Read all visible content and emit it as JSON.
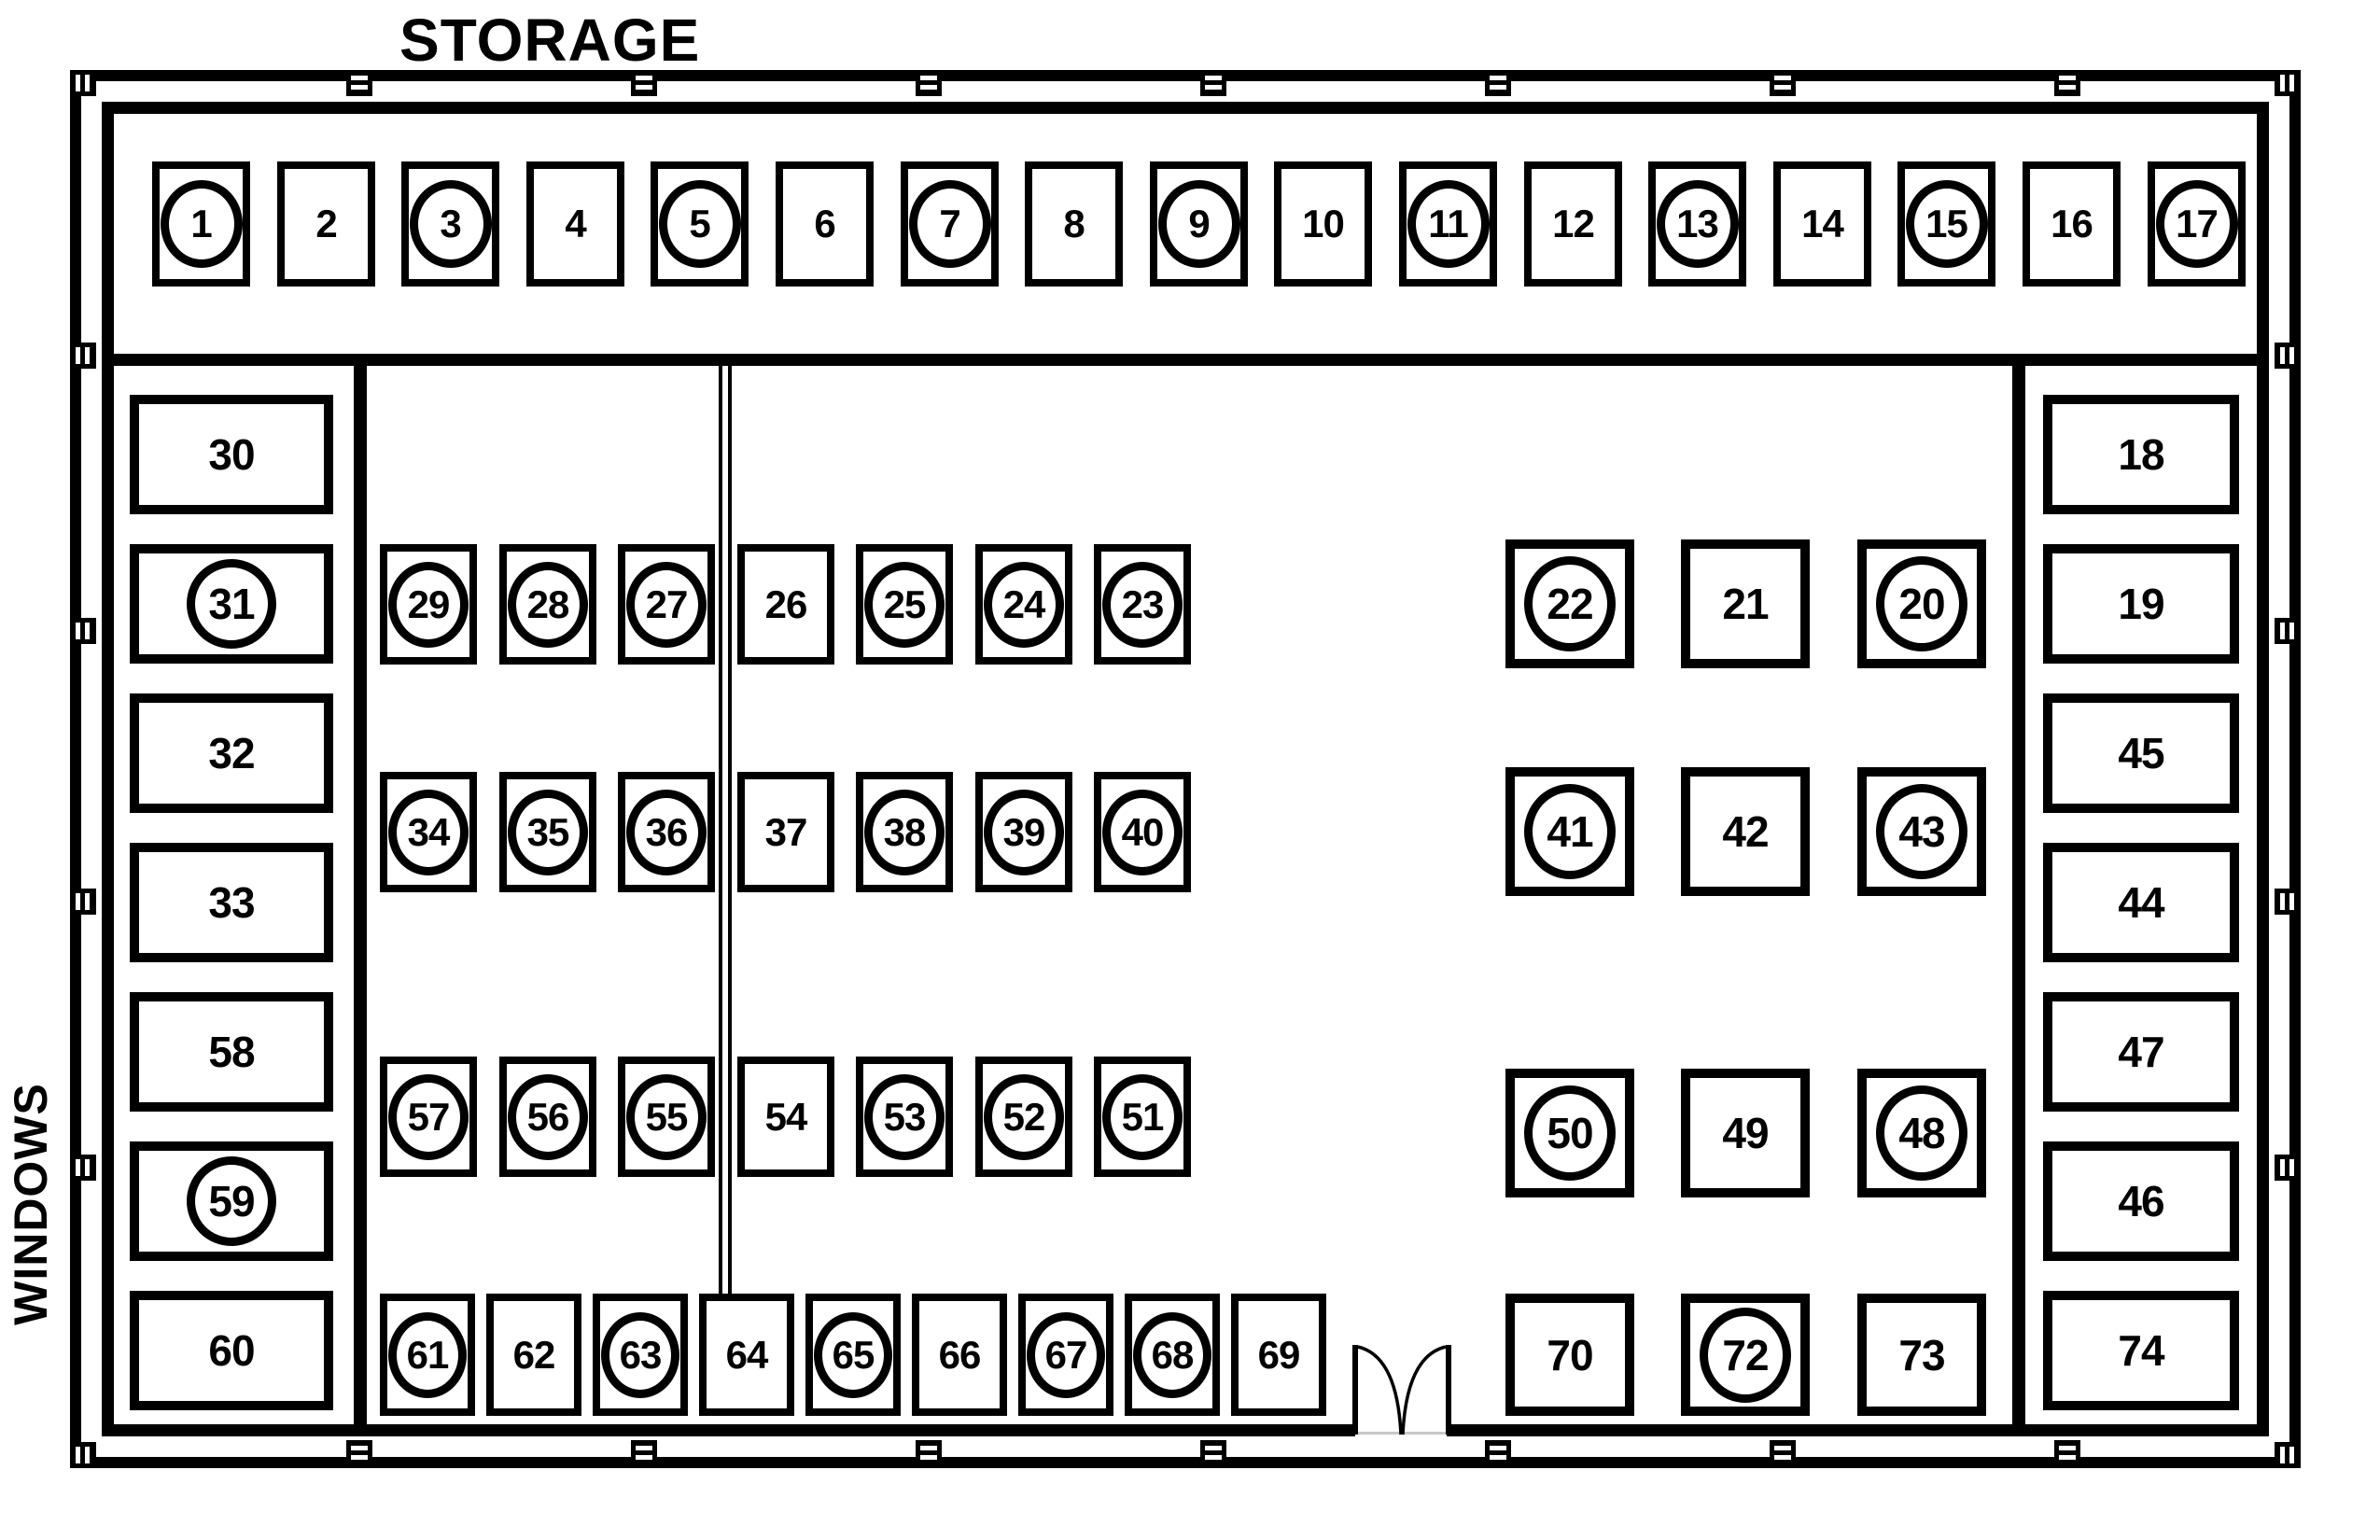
{
  "labels": {
    "storage": "STORAGE",
    "windows": "WINDOWS"
  },
  "colors": {
    "line": "#000000",
    "background": "#ffffff",
    "threshold": "#c8c8c8"
  },
  "groups": {
    "top_row": [
      {
        "n": "1",
        "circled": true
      },
      {
        "n": "2",
        "circled": false
      },
      {
        "n": "3",
        "circled": true
      },
      {
        "n": "4",
        "circled": false
      },
      {
        "n": "5",
        "circled": true
      },
      {
        "n": "6",
        "circled": false
      },
      {
        "n": "7",
        "circled": true
      },
      {
        "n": "8",
        "circled": false
      },
      {
        "n": "9",
        "circled": true
      },
      {
        "n": "10",
        "circled": false
      },
      {
        "n": "11",
        "circled": true
      },
      {
        "n": "12",
        "circled": false
      },
      {
        "n": "13",
        "circled": true
      },
      {
        "n": "14",
        "circled": false
      },
      {
        "n": "15",
        "circled": true
      },
      {
        "n": "16",
        "circled": false
      },
      {
        "n": "17",
        "circled": true
      }
    ],
    "left_column": [
      {
        "n": "30",
        "circled": false
      },
      {
        "n": "31",
        "circled": true
      },
      {
        "n": "32",
        "circled": false
      },
      {
        "n": "33",
        "circled": false
      },
      {
        "n": "58",
        "circled": false
      },
      {
        "n": "59",
        "circled": true
      },
      {
        "n": "60",
        "circled": false
      }
    ],
    "right_column": [
      {
        "n": "18",
        "circled": false
      },
      {
        "n": "19",
        "circled": false
      },
      {
        "n": "45",
        "circled": false
      },
      {
        "n": "44",
        "circled": false
      },
      {
        "n": "47",
        "circled": false
      },
      {
        "n": "46",
        "circled": false
      },
      {
        "n": "74",
        "circled": false
      }
    ],
    "mid_rows": [
      [
        {
          "n": "29",
          "circled": true
        },
        {
          "n": "28",
          "circled": true
        },
        {
          "n": "27",
          "circled": true
        },
        {
          "n": "26",
          "circled": false
        },
        {
          "n": "25",
          "circled": true
        },
        {
          "n": "24",
          "circled": true
        },
        {
          "n": "23",
          "circled": true
        }
      ],
      [
        {
          "n": "34",
          "circled": true
        },
        {
          "n": "35",
          "circled": true
        },
        {
          "n": "36",
          "circled": true
        },
        {
          "n": "37",
          "circled": false
        },
        {
          "n": "38",
          "circled": true
        },
        {
          "n": "39",
          "circled": true
        },
        {
          "n": "40",
          "circled": true
        }
      ],
      [
        {
          "n": "57",
          "circled": true
        },
        {
          "n": "56",
          "circled": true
        },
        {
          "n": "55",
          "circled": true
        },
        {
          "n": "54",
          "circled": false
        },
        {
          "n": "53",
          "circled": true
        },
        {
          "n": "52",
          "circled": true
        },
        {
          "n": "51",
          "circled": true
        }
      ]
    ],
    "bottom_row": [
      {
        "n": "61",
        "circled": true
      },
      {
        "n": "62",
        "circled": false
      },
      {
        "n": "63",
        "circled": true
      },
      {
        "n": "64",
        "circled": false
      },
      {
        "n": "65",
        "circled": true
      },
      {
        "n": "66",
        "circled": false
      },
      {
        "n": "67",
        "circled": true
      },
      {
        "n": "68",
        "circled": true
      },
      {
        "n": "69",
        "circled": false
      }
    ],
    "right_group_rows": [
      [
        {
          "n": "22",
          "circled": true
        },
        {
          "n": "21",
          "circled": false
        },
        {
          "n": "20",
          "circled": true
        }
      ],
      [
        {
          "n": "41",
          "circled": true
        },
        {
          "n": "42",
          "circled": false
        },
        {
          "n": "43",
          "circled": true
        }
      ],
      [
        {
          "n": "50",
          "circled": true
        },
        {
          "n": "49",
          "circled": false
        },
        {
          "n": "48",
          "circled": true
        }
      ],
      [
        {
          "n": "70",
          "circled": false
        },
        {
          "n": "72",
          "circled": true
        },
        {
          "n": "73",
          "circled": false
        }
      ]
    ]
  }
}
